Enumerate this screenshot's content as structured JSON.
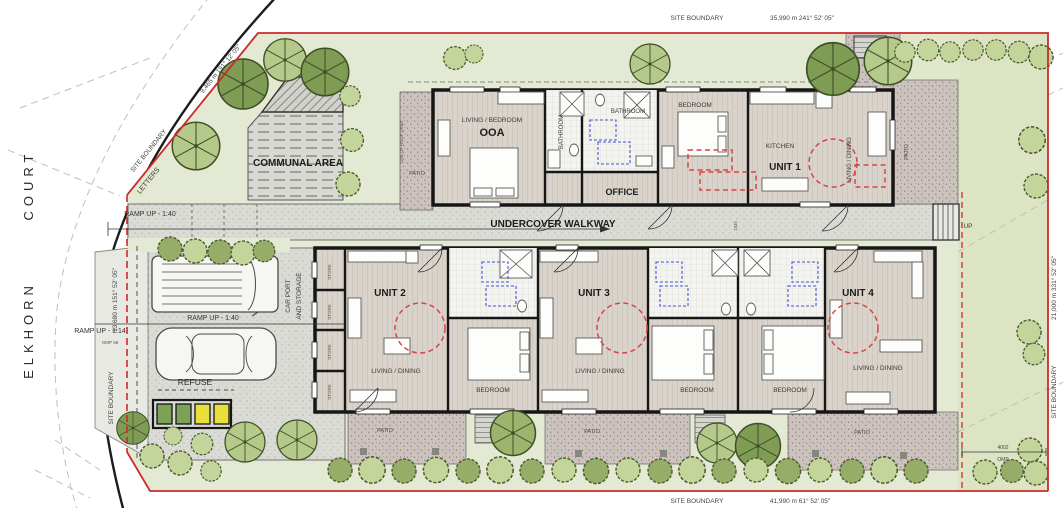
{
  "streets": {
    "court": "COURT",
    "elkhorn": "ELKHORN"
  },
  "boundary": {
    "label": "SITE BOUNDARY",
    "top_dim": "35,990 m 241° 52' 05\"",
    "bottom_dim": "41,990 m 61° 52' 05\"",
    "right_dim": "21,000 m 331° 52' 05\"",
    "left_dim": "13,680 m 151° 52' 05\"",
    "northwest_dim": "9,465 m 191° 12' 05\"",
    "offset_dim": "4002",
    "offset_label": "OMP",
    "ramp_note": "OMP 56"
  },
  "site": {
    "communal": "COMMUNAL AREA",
    "letters": "LETTERS",
    "ramp_140": "RAMP UP - 1:40",
    "ramp_114": "RAMP UP - 1:14",
    "carport_l1": "CAR PORT",
    "carport_l2": "AND STORAGE",
    "refuse": "REFUSE",
    "walkway": "UNDERCOVER WALKWAY",
    "walkway_width": "1935",
    "store": "STORE",
    "up": "UP",
    "roof_line": "LINE OF ROOF OVER",
    "patio": "PATIO"
  },
  "rooms": {
    "living_bedroom": "LIVING / BEDROOM",
    "ooa": "OOA",
    "bathroom": "BATHROOM",
    "office": "OFFICE",
    "bedroom": "BEDROOM",
    "kitchen": "KITCHEN",
    "living_dining": "LIVING / DINING",
    "unit1": "UNIT 1",
    "unit2": "UNIT 2",
    "unit3": "UNIT 3",
    "unit4": "UNIT 4"
  },
  "colors": {
    "boundary_red": "#cc2a2a",
    "accessible_red": "#d64545",
    "fixture_blue": "#4553d6",
    "tree_dark": "#7f9c55",
    "tree_light": "#b4c98a",
    "paving_gray": "#dbdbd6",
    "paving_mauve": "#cdc3be",
    "lawn_green": "#e3e9d2",
    "bin_green": "#7da257",
    "bin_yellow": "#e8df3a"
  }
}
